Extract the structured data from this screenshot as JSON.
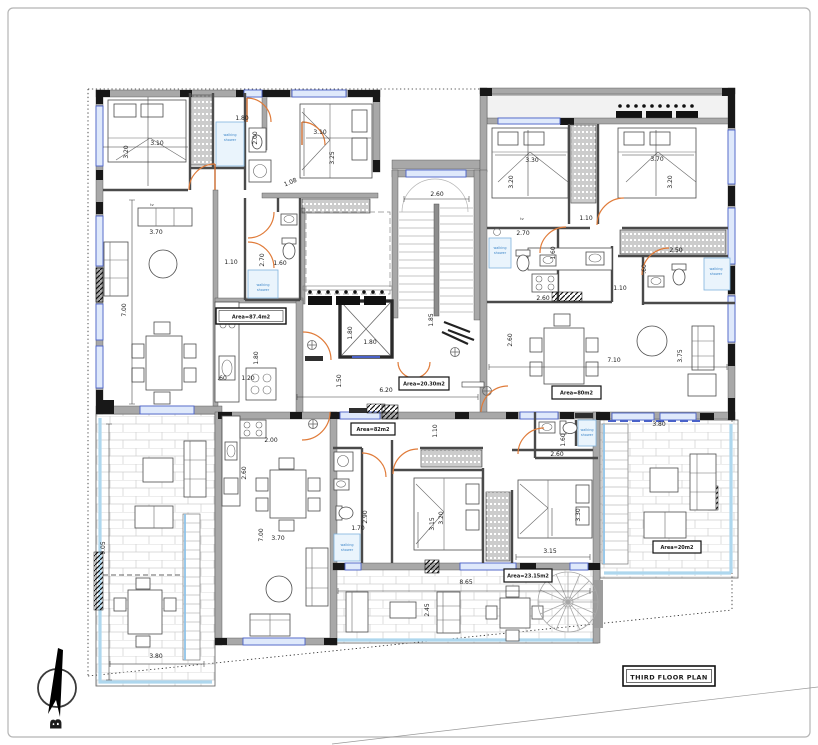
{
  "title_box": {
    "label": "THIRD FLOOR PLAN"
  },
  "compass": {
    "letter": "B"
  },
  "areas": {
    "unit_top_left": "Area=87.4m2",
    "core": "Area=20.30m2",
    "unit_top_right": "Area=80m2",
    "unit_bottom": "Area=82m2",
    "terrace_bottom": "Area=23.15m2",
    "terrace_right": "Area=20m2"
  },
  "labels": {
    "walking": "walking",
    "shower": "shower",
    "tv": "tv"
  },
  "colors": {
    "door_arc": "#e07b39",
    "window_frame": "#4a62c9",
    "shower_blue": "#7fb3dc",
    "terrace_band": "#aed7ee",
    "wall_gray": "#a8a8a8",
    "pier_black": "#181818"
  },
  "dims": {
    "tl_bed1_h": "3.20",
    "tl_bed1_w": "3.10",
    "tl_shower_w": "1.80",
    "tl_shower_h": "2.00",
    "tl_bed2_w": "3.10",
    "tl_bed2_h": "3.25",
    "tl_diag": "1.08",
    "tl_tv": "3.70",
    "tl_left": "7.00",
    "tl_hall_w": "1.10",
    "tl_hall_h": "2.70",
    "tl_hall2": "1.60",
    "tl_k_115": "1.15",
    "tl_k_180": "1.80",
    "tl_k_60": ".60",
    "tl_k_120": "1.20",
    "core_win": "2.60",
    "core_lift_a": "1.80",
    "core_lift_b": "1.80",
    "core_185": "1.85",
    "core_150": "1.50",
    "core_620": "6.20",
    "tr_bed3_w": "3.30",
    "tr_bed3_h": "3.20",
    "tr_bed4_w": "3.70",
    "tr_bed4_h": "3.20",
    "tr_110a": "1.10",
    "tr_270": "2.70",
    "tr_160": "1.60",
    "tr_250": "2.50",
    "tr_60": ".60",
    "tr_110b": "1.10",
    "tr_260a": "2.60",
    "tr_260b": "2.60",
    "tr_710": "7.10",
    "tr_375": "3.75",
    "b_200": "2.00",
    "b_260": "2.60",
    "b_700": "7.00",
    "b_370": "3.70",
    "b_170": "1.70",
    "b_290": "2.90",
    "b_110": "1.10",
    "b_315a": "3.15",
    "b_320": "3.20",
    "b_330": "3.30",
    "b_315b": "3.15",
    "b_160": "1.60",
    "b_260b": "2.60",
    "t1_905": "9.05",
    "t1_380": "3.80",
    "t2_865": "8.65",
    "t2_245": "2.45",
    "t3_380": "3.80"
  }
}
